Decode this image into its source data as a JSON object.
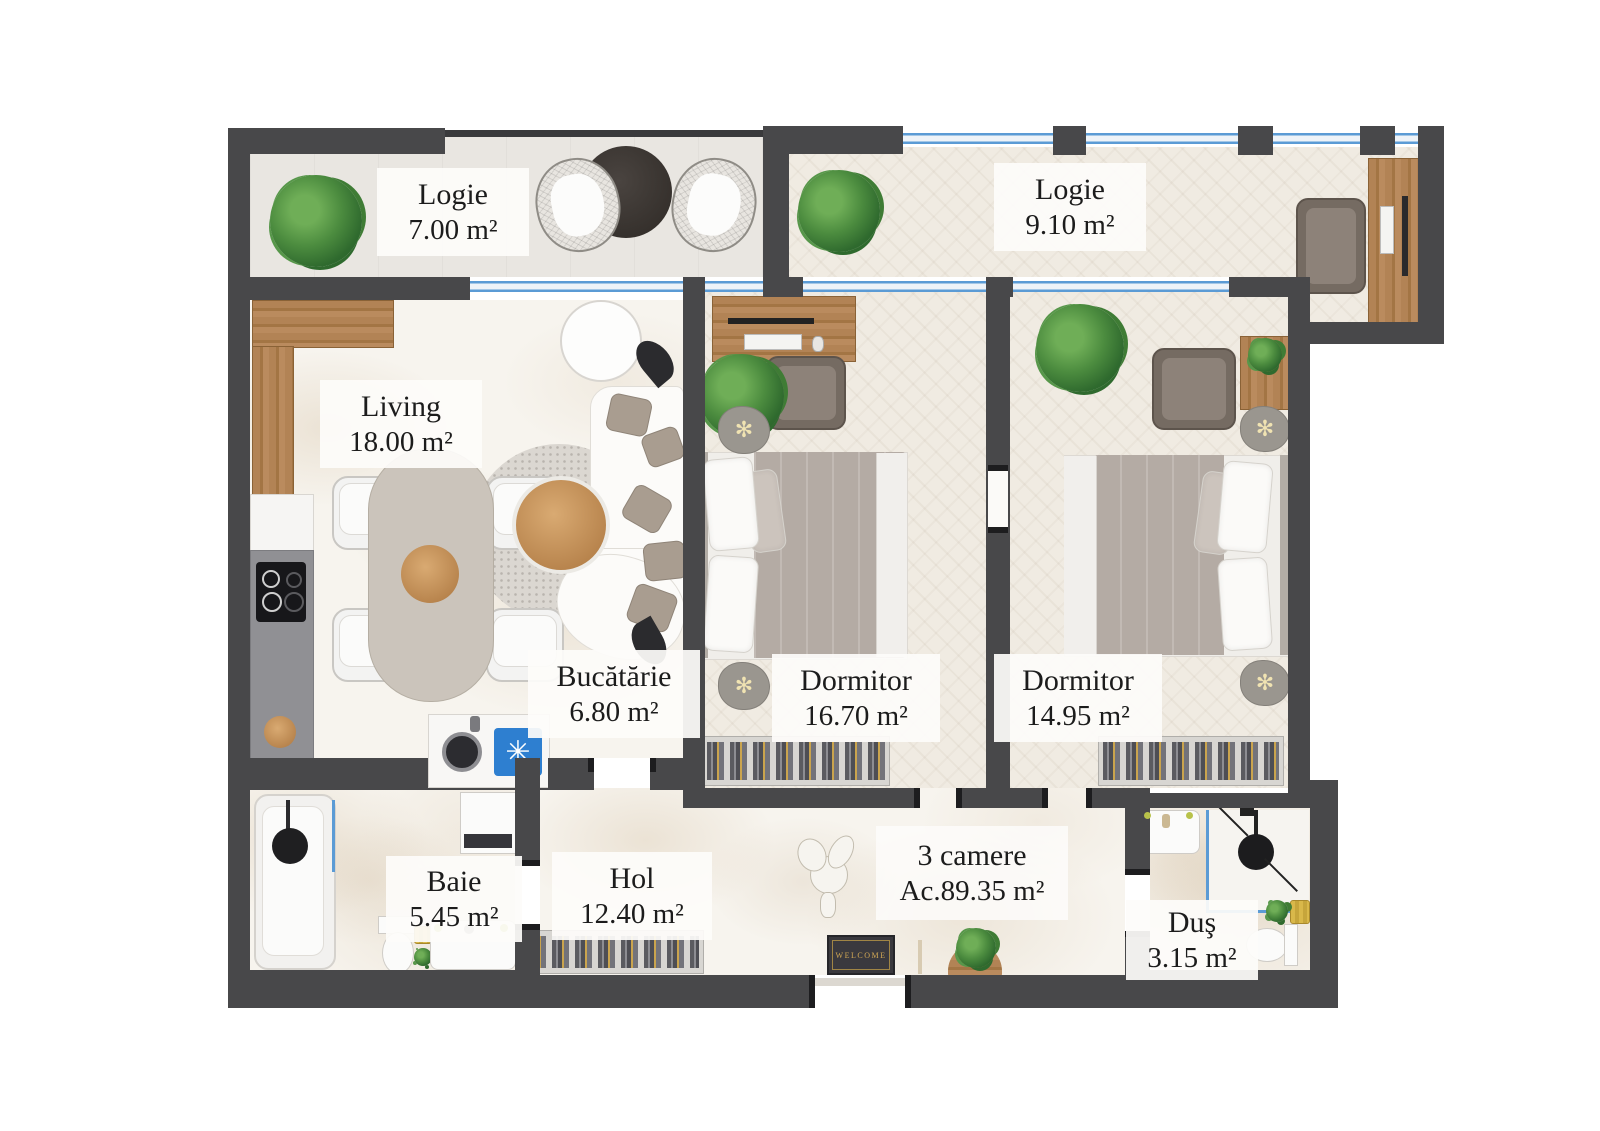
{
  "apartment": {
    "title": "3 camere",
    "area": "Ac.89.35 m²"
  },
  "rooms": [
    {
      "name": "Logie",
      "area": "7.00 m²"
    },
    {
      "name": "Logie",
      "area": "9.10 m²"
    },
    {
      "name": "Living",
      "area": "18.00 m²"
    },
    {
      "name": "Bucătărie",
      "area": "6.80 m²"
    },
    {
      "name": "Dormitor",
      "area": "16.70 m²"
    },
    {
      "name": "Dormitor",
      "area": "14.95 m²"
    },
    {
      "name": "Baie",
      "area": "5.45 m²"
    },
    {
      "name": "Hol",
      "area": "12.40 m²"
    },
    {
      "name": "Duş",
      "area": "3.15 m²"
    }
  ],
  "doormat_text": "WELCOME",
  "icons": {
    "freezer_glyph": "✳",
    "lamp_glyph": "✻"
  },
  "colors": {
    "wall": "#48484a",
    "window_blue": "#5b9bd5",
    "doormat_gold": "#d2a855",
    "wood": "#ab7c4e",
    "plant_green": "#3f7c35",
    "duvet_taupe": "#b4aba4",
    "marble_floor": "#f7f4ee",
    "bedroom_floor": "#f0ebe2"
  }
}
